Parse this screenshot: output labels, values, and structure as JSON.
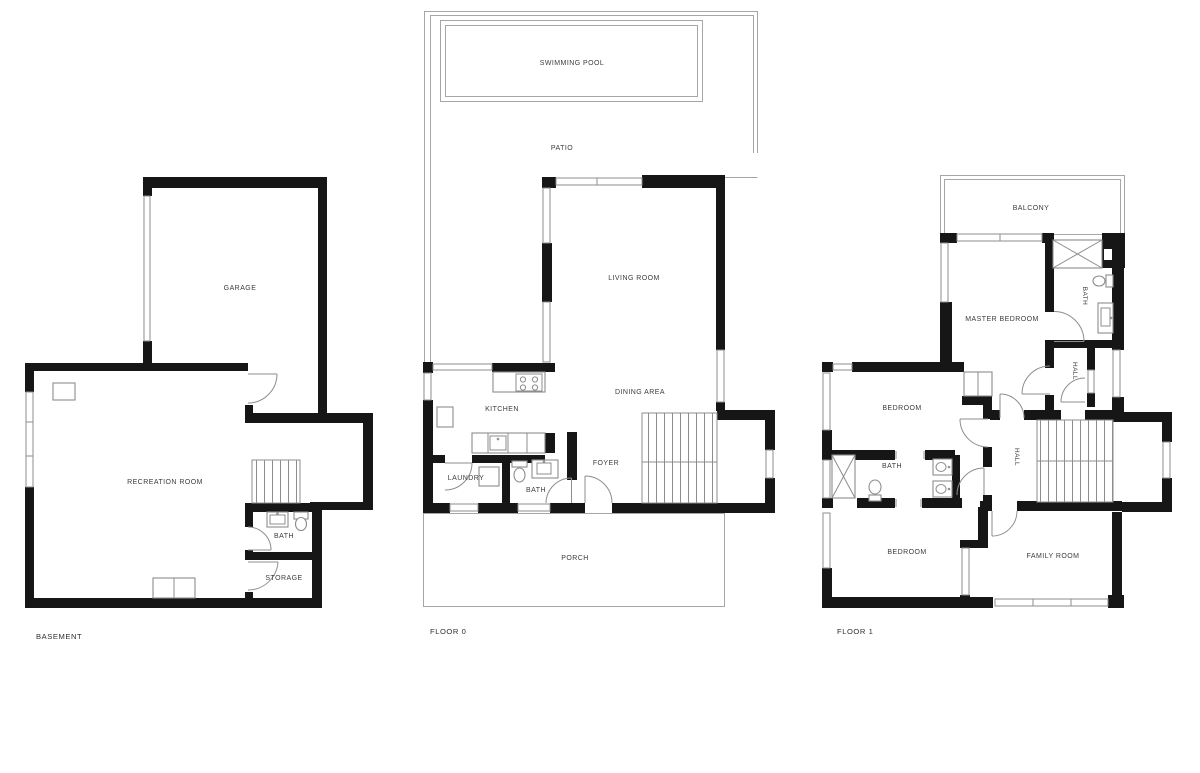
{
  "document": {
    "type": "architectural floor plans",
    "plan_count": 3
  },
  "colors": {
    "wall": "#161616",
    "outline": "#a6a6a6",
    "fixture": "#8d8d8d",
    "label": "#3c3c3c",
    "bg": "#ffffff"
  },
  "plans": {
    "basement": {
      "title": "BASEMENT",
      "rooms": {
        "garage": "GARAGE",
        "recreation": "RECREATION ROOM",
        "bath": "BATH",
        "storage": "STORAGE"
      }
    },
    "floor0": {
      "title": "FLOOR 0",
      "rooms": {
        "pool": "SWIMMING POOL",
        "patio": "PATIO",
        "living": "LIVING ROOM",
        "dining": "DINING AREA",
        "kitchen": "KITCHEN",
        "laundry": "LAUNDRY",
        "bath": "BATH",
        "foyer": "FOYER",
        "porch": "PORCH"
      }
    },
    "floor1": {
      "title": "FLOOR 1",
      "rooms": {
        "balcony": "BALCONY",
        "master": "MASTER BEDROOM",
        "bath_top": "BATH",
        "hall_top": "HALL",
        "bedroom_top": "BEDROOM",
        "bath_mid": "BATH",
        "hall_main": "HALL",
        "bedroom_bottom": "BEDROOM",
        "family": "FAMILY ROOM"
      }
    }
  }
}
